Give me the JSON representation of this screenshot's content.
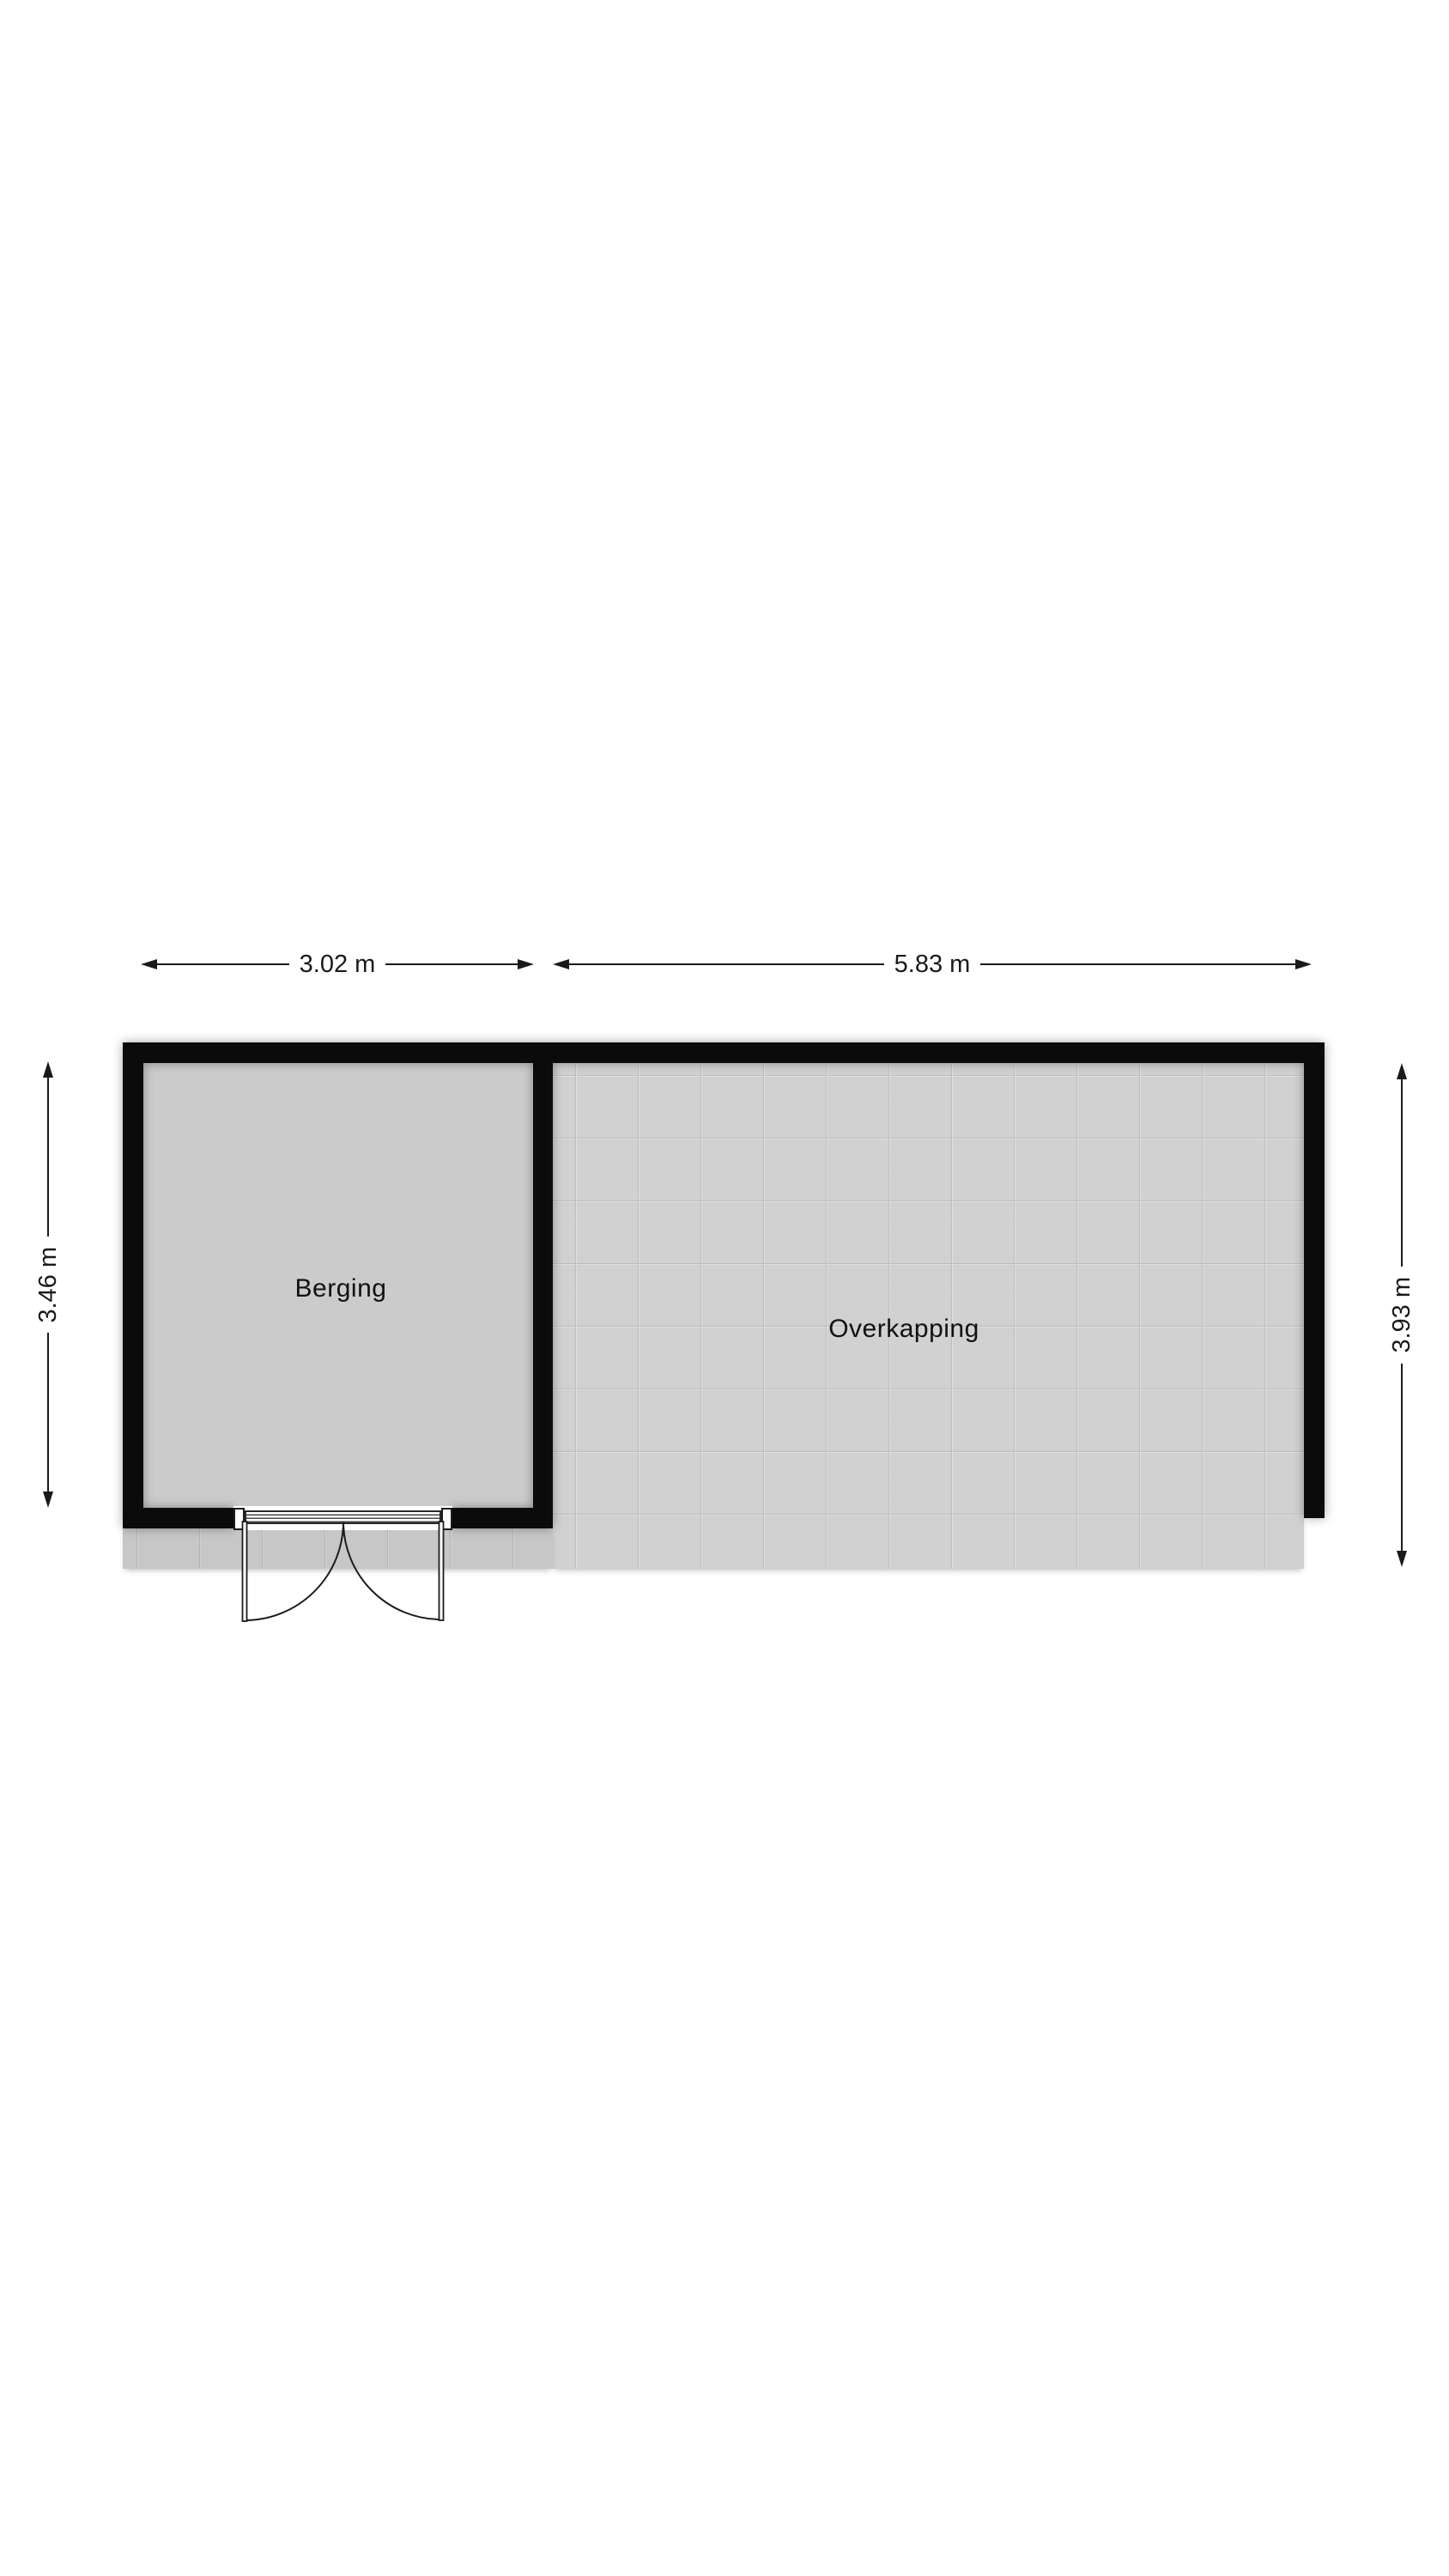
{
  "floorplan": {
    "rooms": {
      "berging": {
        "label": "Berging",
        "width": "3.02 m",
        "height": "3.46 m"
      },
      "overkapping": {
        "label": "Overkapping",
        "width": "5.83 m",
        "depth": "3.93 m"
      }
    },
    "colors": {
      "wall": "#0b0b0b",
      "berging_floor": "#cbcbcb",
      "overkapping_floor": "#d1d1d1",
      "apron_floor": "#c7c7c7",
      "dimension_text": "#1a1a1a",
      "background": "#ffffff"
    }
  }
}
